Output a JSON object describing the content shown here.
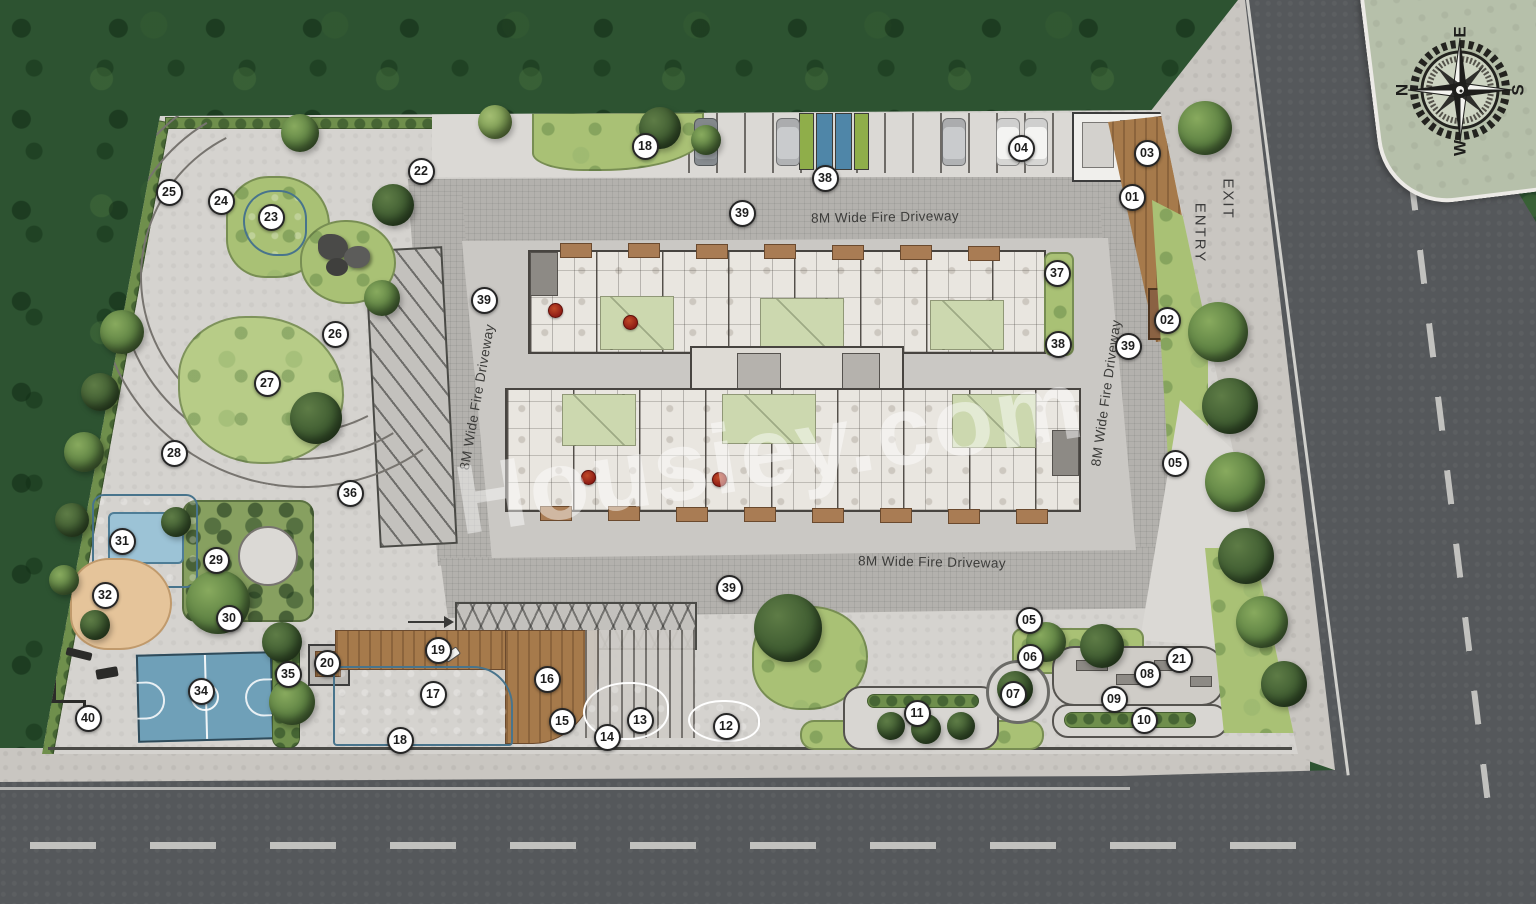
{
  "plan": {
    "watermark": "Housiey.com",
    "fire_driveway_label": "8M Wide Fire Driveway",
    "entry_label": "ENTRY",
    "exit_label": "EXIT",
    "compass": {
      "north": "N",
      "east": "E",
      "south": "S",
      "west": "W"
    },
    "palette": {
      "grass": "#2d5331",
      "pavement": "#d5d3cf",
      "driveway": "#b3b1ad",
      "road": "#55585b",
      "pool_blue": "#6fa3bd",
      "lawn_green": "#a9c175",
      "deck_brown": "#a67a4b",
      "court_blue": "#6fa0b8",
      "marker_red": "#8f1d15",
      "compass_panel": "#b6c0aa"
    },
    "driveway_label_positions": [
      {
        "x": 885,
        "y": 217,
        "rot": -1
      },
      {
        "x": 932,
        "y": 562,
        "rot": 1
      },
      {
        "x": 477,
        "y": 397,
        "rot": -80
      },
      {
        "x": 1106,
        "y": 393,
        "rot": -82
      }
    ],
    "markers": [
      {
        "label": "01",
        "x": 1132,
        "y": 197
      },
      {
        "label": "02",
        "x": 1167,
        "y": 320
      },
      {
        "label": "03",
        "x": 1147,
        "y": 153
      },
      {
        "label": "04",
        "x": 1021,
        "y": 148
      },
      {
        "label": "05",
        "x": 1175,
        "y": 463
      },
      {
        "label": "05",
        "x": 1029,
        "y": 620
      },
      {
        "label": "06",
        "x": 1030,
        "y": 657
      },
      {
        "label": "07",
        "x": 1013,
        "y": 694
      },
      {
        "label": "08",
        "x": 1147,
        "y": 674
      },
      {
        "label": "09",
        "x": 1114,
        "y": 699
      },
      {
        "label": "10",
        "x": 1144,
        "y": 720
      },
      {
        "label": "11",
        "x": 917,
        "y": 713
      },
      {
        "label": "12",
        "x": 726,
        "y": 726
      },
      {
        "label": "13",
        "x": 640,
        "y": 720
      },
      {
        "label": "14",
        "x": 607,
        "y": 737
      },
      {
        "label": "15",
        "x": 562,
        "y": 721
      },
      {
        "label": "16",
        "x": 547,
        "y": 679
      },
      {
        "label": "17",
        "x": 433,
        "y": 694
      },
      {
        "label": "18",
        "x": 645,
        "y": 146
      },
      {
        "label": "18",
        "x": 400,
        "y": 740
      },
      {
        "label": "19",
        "x": 438,
        "y": 650
      },
      {
        "label": "20",
        "x": 327,
        "y": 663
      },
      {
        "label": "21",
        "x": 1179,
        "y": 659
      },
      {
        "label": "22",
        "x": 421,
        "y": 171
      },
      {
        "label": "23",
        "x": 271,
        "y": 217
      },
      {
        "label": "24",
        "x": 221,
        "y": 201
      },
      {
        "label": "25",
        "x": 169,
        "y": 192
      },
      {
        "label": "26",
        "x": 335,
        "y": 334
      },
      {
        "label": "27",
        "x": 267,
        "y": 383
      },
      {
        "label": "28",
        "x": 174,
        "y": 453
      },
      {
        "label": "29",
        "x": 216,
        "y": 560
      },
      {
        "label": "30",
        "x": 229,
        "y": 618
      },
      {
        "label": "31",
        "x": 122,
        "y": 541
      },
      {
        "label": "32",
        "x": 105,
        "y": 595
      },
      {
        "label": "34",
        "x": 201,
        "y": 691
      },
      {
        "label": "35",
        "x": 288,
        "y": 674
      },
      {
        "label": "36",
        "x": 350,
        "y": 493
      },
      {
        "label": "37",
        "x": 1057,
        "y": 273
      },
      {
        "label": "38",
        "x": 825,
        "y": 178
      },
      {
        "label": "38",
        "x": 1058,
        "y": 344
      },
      {
        "label": "39",
        "x": 742,
        "y": 213
      },
      {
        "label": "39",
        "x": 484,
        "y": 300
      },
      {
        "label": "39",
        "x": 1128,
        "y": 346
      },
      {
        "label": "39",
        "x": 729,
        "y": 588
      },
      {
        "label": "40",
        "x": 88,
        "y": 718
      }
    ]
  }
}
